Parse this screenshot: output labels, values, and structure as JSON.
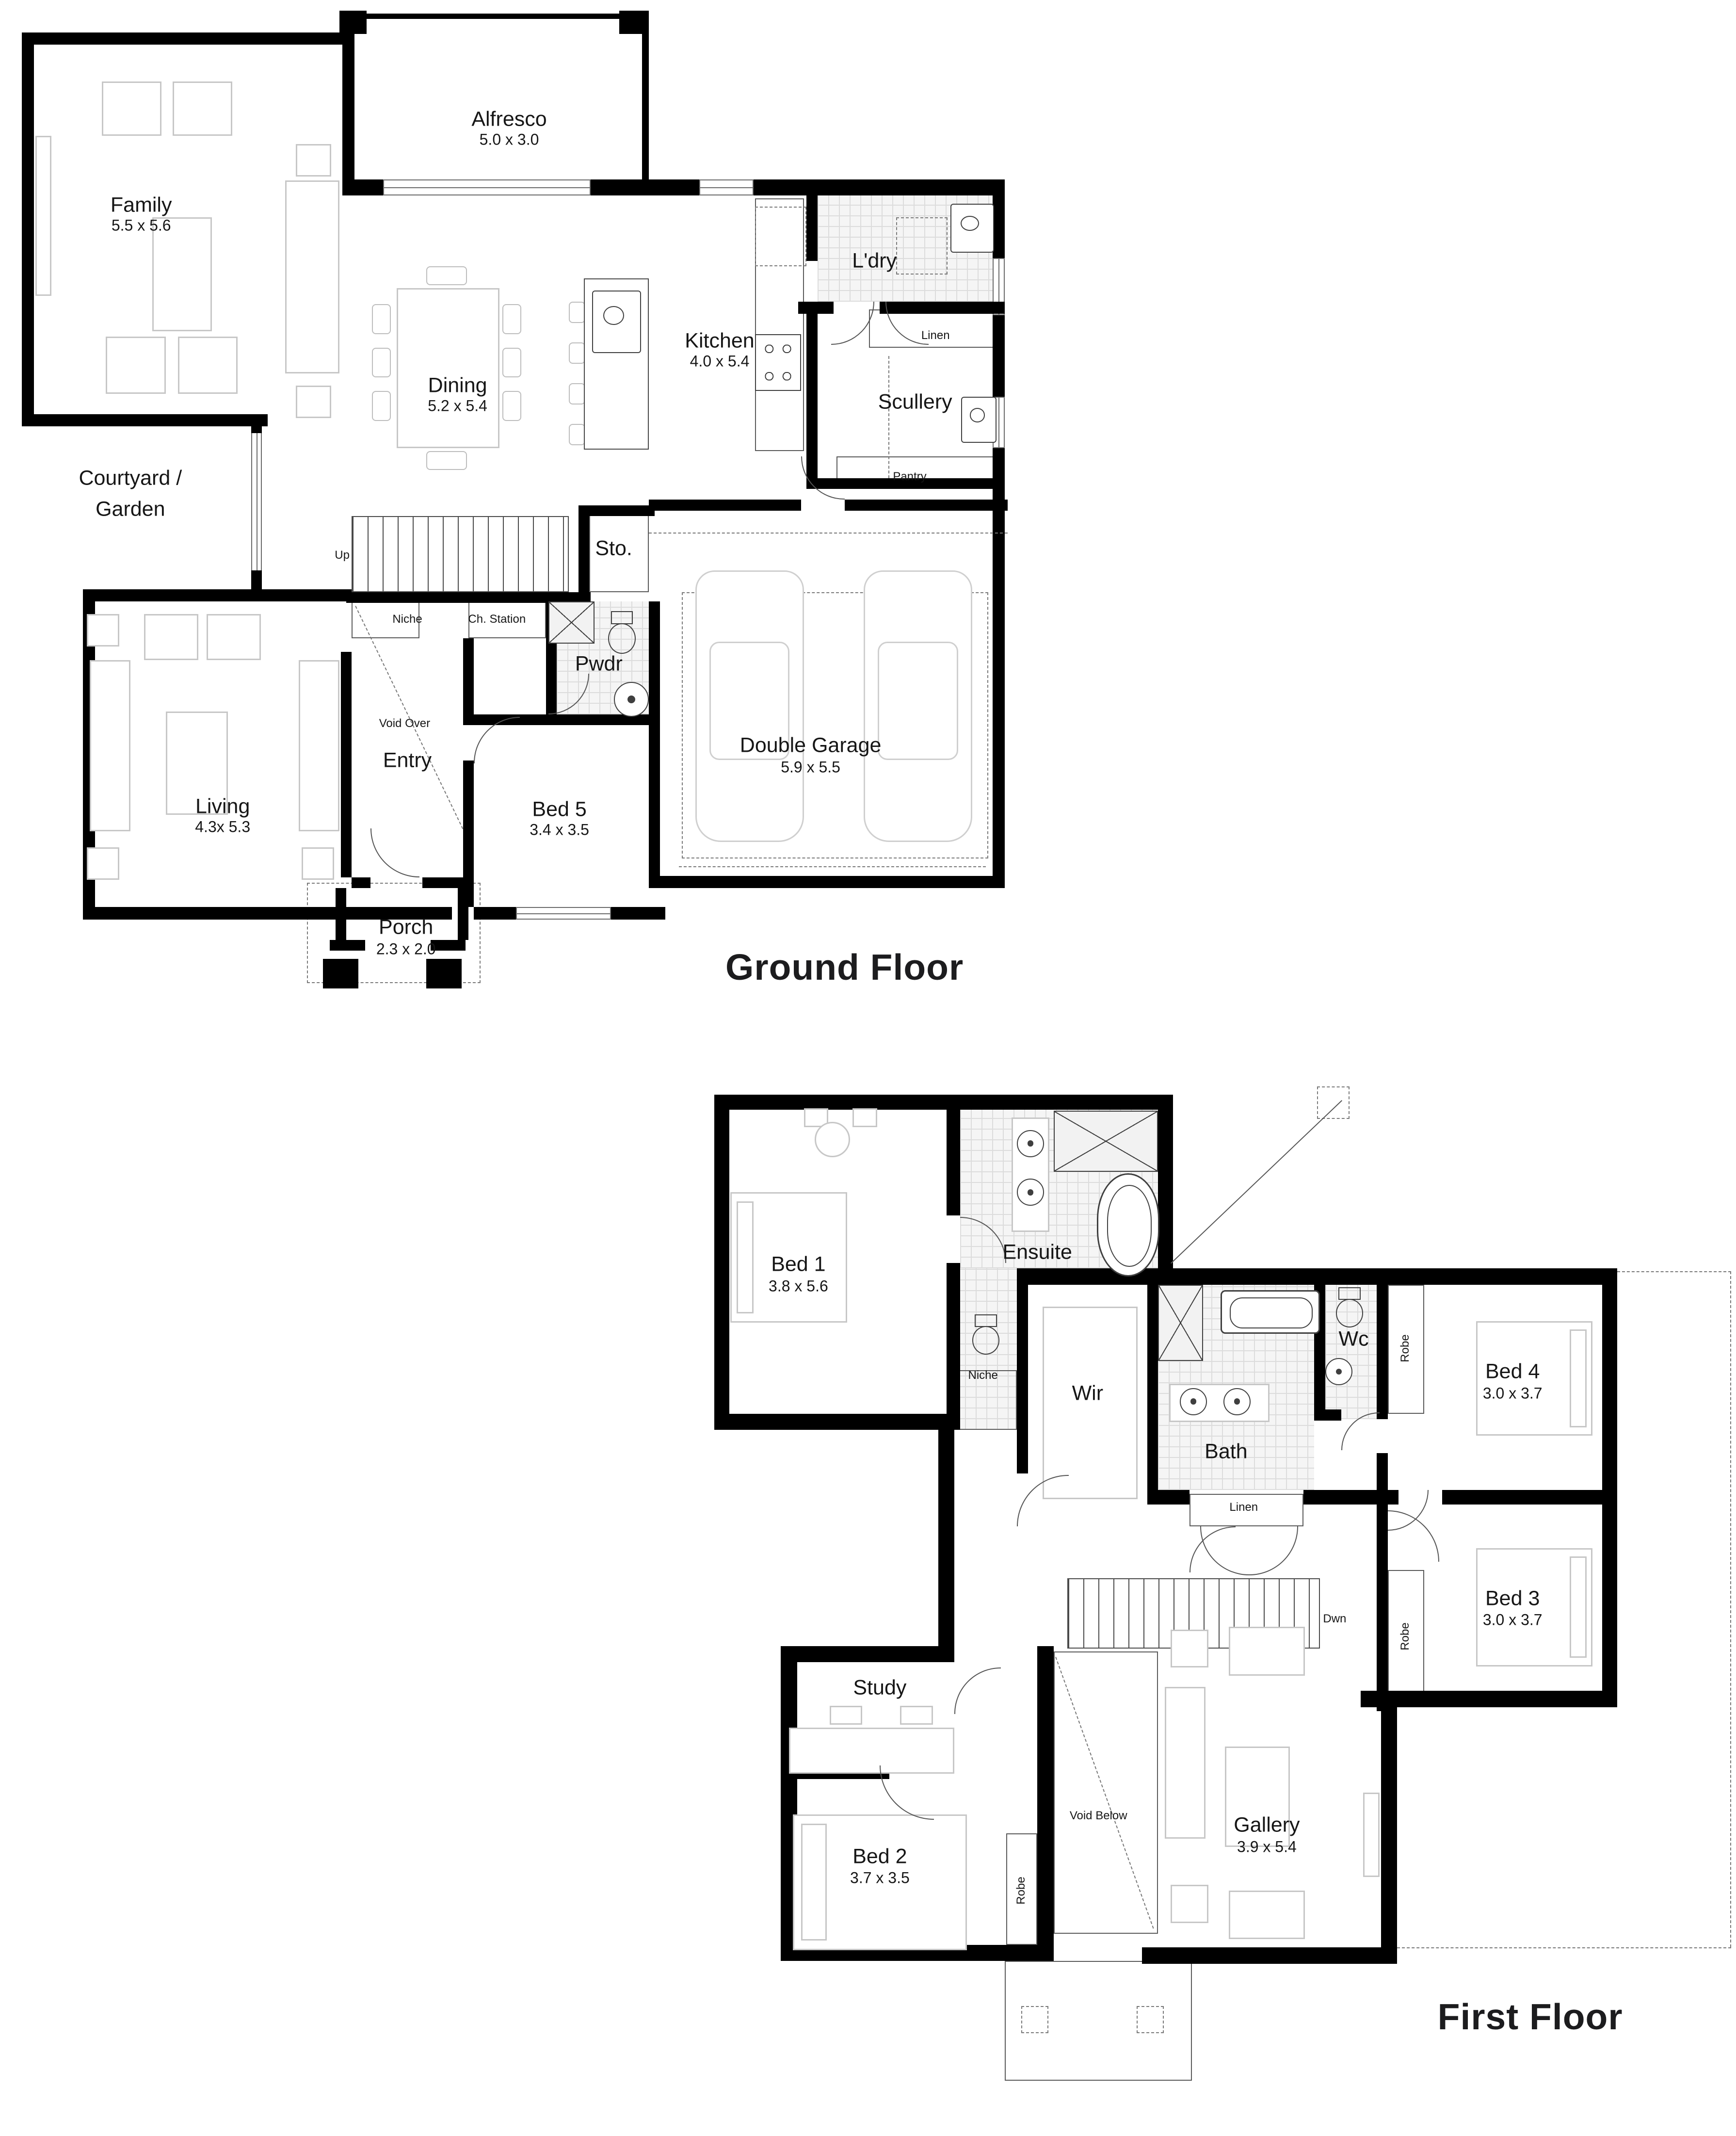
{
  "floors": {
    "ground": {
      "title": "Ground Floor",
      "rooms": {
        "family": {
          "name": "Family",
          "dims": "5.5 x 5.6"
        },
        "alfresco": {
          "name": "Alfresco",
          "dims": "5.0 x 3.0"
        },
        "dining": {
          "name": "Dining",
          "dims": "5.2 x 5.4"
        },
        "kitchen": {
          "name": "Kitchen",
          "dims": "4.0 x 5.4"
        },
        "ldry": {
          "name": "L'dry"
        },
        "linen": {
          "name": "Linen"
        },
        "scullery": {
          "name": "Scullery"
        },
        "pantry": {
          "name": "Pantry"
        },
        "courtyard": {
          "line1": "Courtyard /",
          "line2": "Garden"
        },
        "sto": {
          "name": "Sto."
        },
        "up": {
          "name": "Up"
        },
        "niche": {
          "name": "Niche"
        },
        "ch_station": {
          "name": "Ch. Station"
        },
        "void_over": {
          "name": "Void Over"
        },
        "entry": {
          "name": "Entry"
        },
        "pwdr": {
          "name": "Pwdr"
        },
        "living": {
          "name": "Living",
          "dims": "4.3x 5.3"
        },
        "bed5": {
          "name": "Bed 5",
          "dims": "3.4 x 3.5"
        },
        "porch": {
          "name": "Porch",
          "dims": "2.3 x 2.0"
        },
        "garage": {
          "name": "Double Garage",
          "dims": "5.9 x 5.5"
        }
      }
    },
    "first": {
      "title": "First Floor",
      "rooms": {
        "bed1": {
          "name": "Bed 1",
          "dims": "3.8 x 5.6"
        },
        "ensuite": {
          "name": "Ensuite"
        },
        "niche": {
          "name": "Niche"
        },
        "wir": {
          "name": "Wir"
        },
        "bath": {
          "name": "Bath"
        },
        "linen": {
          "name": "Linen"
        },
        "wc": {
          "name": "Wc"
        },
        "robe_bed4": {
          "name": "Robe"
        },
        "bed4": {
          "name": "Bed 4",
          "dims": "3.0 x 3.7"
        },
        "bed3": {
          "name": "Bed 3",
          "dims": "3.0 x 3.7"
        },
        "robe_bed3": {
          "name": "Robe"
        },
        "dwn": {
          "name": "Dwn"
        },
        "study": {
          "name": "Study"
        },
        "bed2": {
          "name": "Bed 2",
          "dims": "3.7 x 3.5"
        },
        "robe_bed2": {
          "name": "Robe"
        },
        "void_below": {
          "name": "Void Below"
        },
        "gallery": {
          "name": "Gallery",
          "dims": "3.9 x 5.4"
        }
      }
    }
  }
}
